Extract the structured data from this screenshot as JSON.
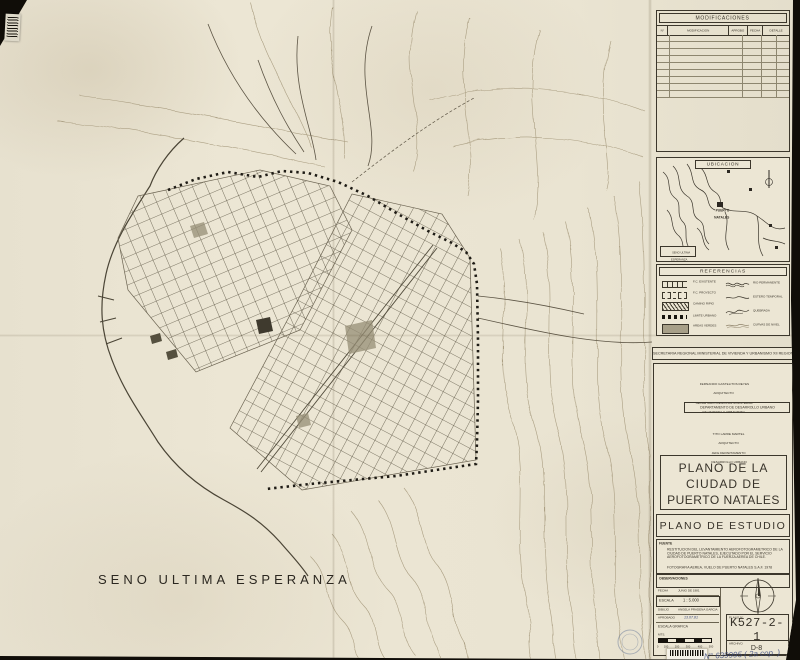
{
  "map": {
    "sea_label": "SENO ULTIMA ESPERANZA"
  },
  "modificaciones": {
    "title": "MODIFICACIONES",
    "columns": [
      "N°",
      "MODIFICACION",
      "APROBO",
      "FECHA",
      "DETALLE"
    ]
  },
  "ubicacion": {
    "title": "UBICACION",
    "city_label_1": "PUERTO",
    "city_label_2": "NATALES",
    "corner_label_1": "SENO ULTIMA",
    "corner_label_2": "ESPERANZA"
  },
  "referencias": {
    "title": "REFERENCIAS",
    "left": [
      {
        "label": "F.C. EXISTENTE"
      },
      {
        "label": "F.C. PROYECTO"
      },
      {
        "label": "CAMINO RIPIO"
      },
      {
        "label": "LIMITE URBANO"
      },
      {
        "label": "AREAS VERDES"
      }
    ],
    "right": [
      {
        "label": "RIO PERMANENTE"
      },
      {
        "label": "ESTERO TEMPORAL"
      },
      {
        "label": "QUEBRADA"
      },
      {
        "label": "CURVAS DE NIVEL"
      }
    ]
  },
  "titulo": {
    "banner": "SECRETARIA REGIONAL MINISTERIAL DE VIVIENDA Y URBANISMO XII REGION",
    "firma1_1": "FERNANDO GASTELITOS REYES",
    "firma1_2": "ARQUITECTO",
    "firma1_3": "SECRETARIO REGIONAL MINISTERIAL",
    "firma1_4": "DE VIVIENDA Y URBANISMO",
    "departamento": "DEPARTAMENTO DE DESARROLLO URBANO",
    "firma2_1": "TITO LARRE MARTEL",
    "firma2_2": "ARQUITECTO",
    "firma2_3": "JEFE DEPARTAMENTO",
    "firma2_4": "DESARROLLO URBANO",
    "plano_titulo_1": "PLANO  DE  LA",
    "plano_titulo_2": "CIUDAD    DE",
    "plano_titulo_3": "PUERTO NATALES",
    "subtitulo": "PLANO DE ESTUDIO"
  },
  "fuente": {
    "label": "FUENTE",
    "item1": "RESTITUCION DEL LEVANTAMIENTO AEROFOTOGRAMETRICO DE LA CIUDAD DE PUERTO NATALES, EJECUTADO POR EL SERVICIO AEROFOTOGRAMETRICO DE LA FUERZA AEREA DE CHILE.",
    "item2": "FOTOGRAFIA AEREA, VUELO DE PUERTO NATALES S.A.F. 1978"
  },
  "observaciones": {
    "label": "OBSERVACIONES"
  },
  "meta": {
    "fecha_label": "FECHA",
    "fecha": "JUNIO DE 1981",
    "escala_label": "ESCALA",
    "escala": "1 : 5.000",
    "dibujo_label": "DIBUJO",
    "dibujo": "ANGELA PRADENA GARCIA",
    "aprobado_label": "APROBADO",
    "aprobado": "13.07.81",
    "escala_grafica": "ESCALA GRAFICA",
    "unit": "MTS.",
    "ticks": [
      "0",
      "100",
      "200",
      "300",
      "400",
      "500"
    ],
    "plano_label": "PLANO  N°",
    "plano_numero": "K527-2-1",
    "archivo_label": "ARCHIVO",
    "archivo": "D-8",
    "nota_manuscrita": "N° 639995 ( 2a cop. )"
  },
  "colors": {
    "paper": "#eae4d2",
    "ink": "#3c372c",
    "contour": "#ab9f83",
    "boundary": "#1e1b15"
  }
}
